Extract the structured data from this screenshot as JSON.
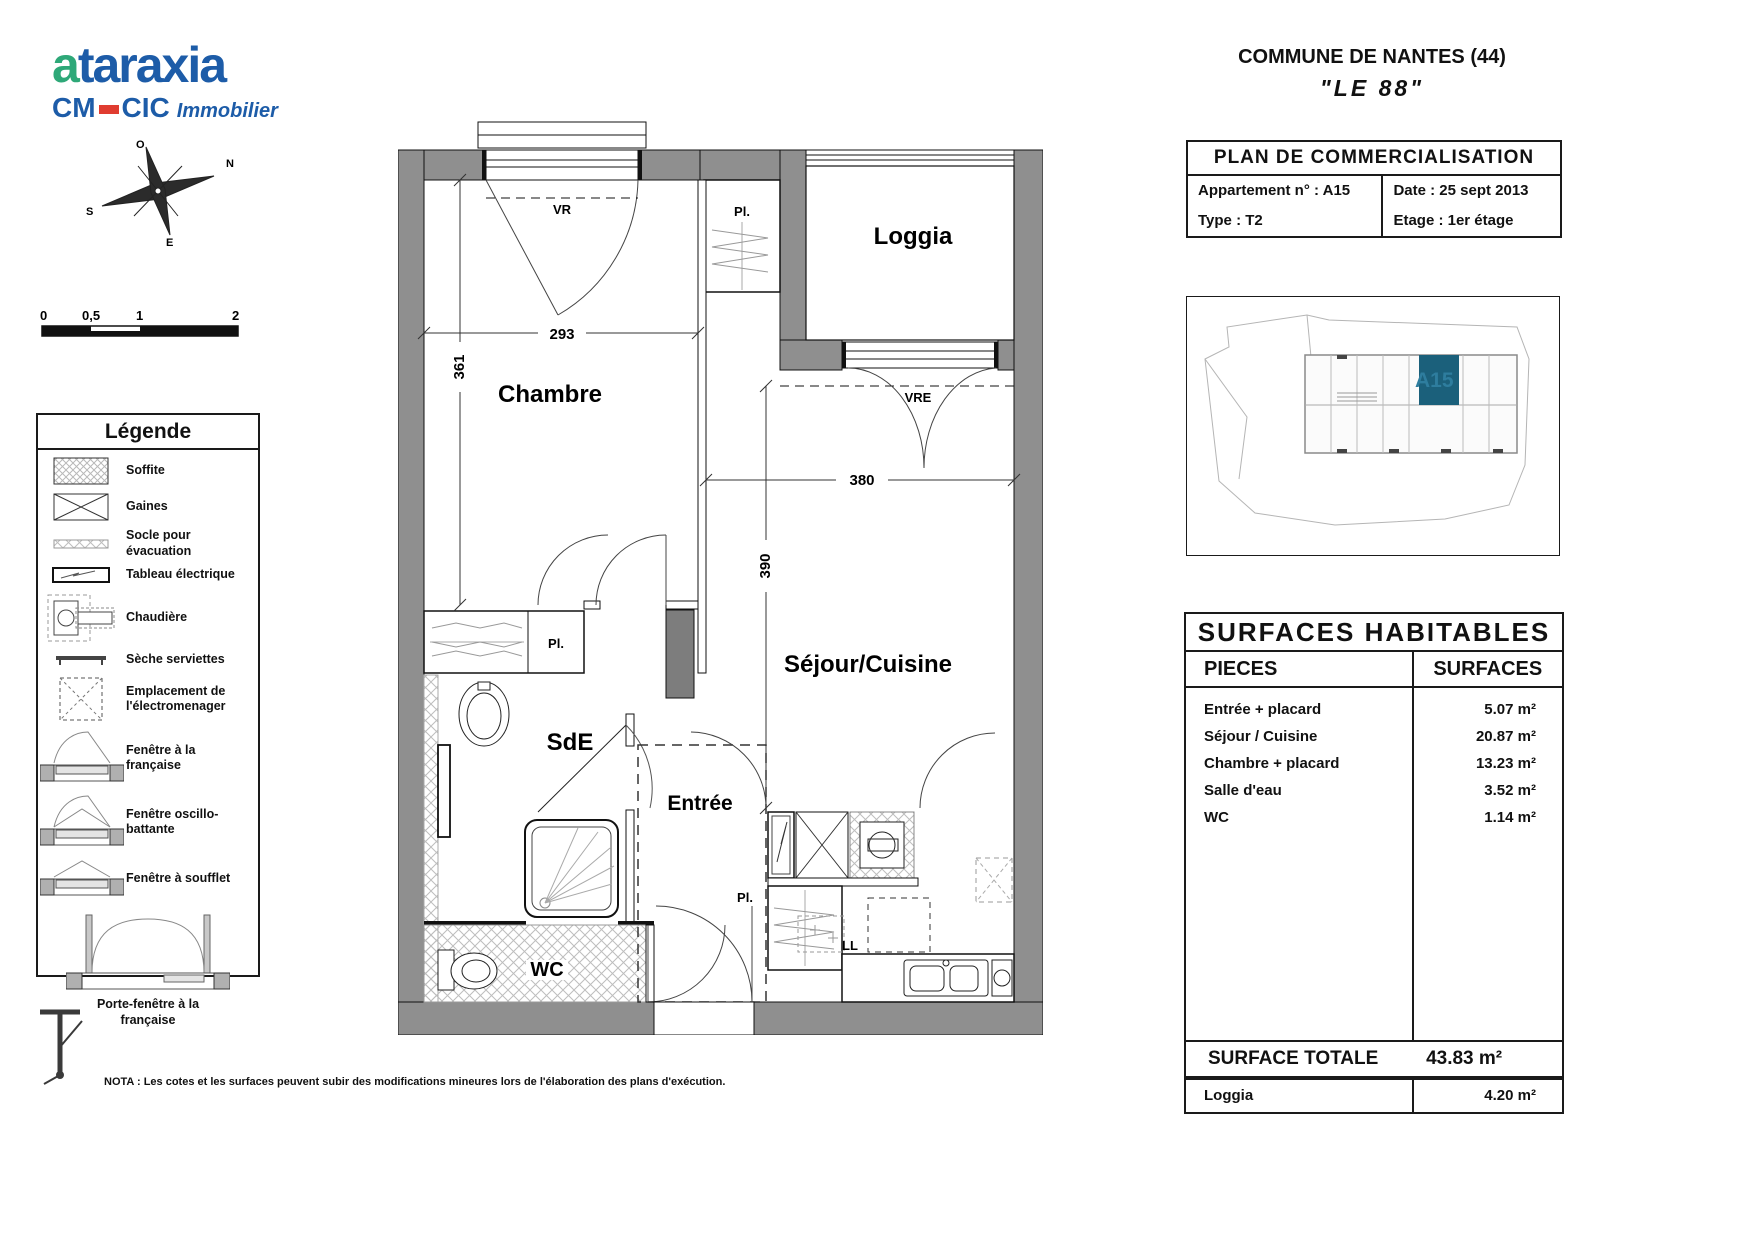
{
  "logo": {
    "brand_a": "a",
    "brand_rest": "taraxia",
    "cm": "CM",
    "cic": "CIC",
    "suffix": "Immobilier"
  },
  "header": {
    "commune": "COMMUNE DE NANTES (44)",
    "residence": "\"LE 88\""
  },
  "info_table": {
    "title": "PLAN DE COMMERCIALISATION",
    "appartement": "Appartement n° :  A15",
    "date": "Date : 25 sept 2013",
    "type": "Type : T2",
    "etage": "Etage : 1er étage"
  },
  "minimap": {
    "unit": "A15",
    "highlight_color": "#1b607b",
    "label_color": "#2e7d9e"
  },
  "surfaces": {
    "title": "SURFACES HABITABLES",
    "col_pieces": "PIECES",
    "col_surfaces": "SURFACES",
    "rows": [
      {
        "piece": "Entrée + placard",
        "surface": "5.07  m²"
      },
      {
        "piece": "Séjour / Cuisine",
        "surface": "20.87  m²"
      },
      {
        "piece": "Chambre + placard",
        "surface": "13.23  m²"
      },
      {
        "piece": "Salle d'eau",
        "surface": "3.52  m²"
      },
      {
        "piece": "WC",
        "surface": "1.14  m²"
      }
    ],
    "total_label": "SURFACE TOTALE",
    "total_value": "43.83 m²",
    "loggia_label": "Loggia",
    "loggia_value": "4.20  m²"
  },
  "legend": {
    "title": "Légende",
    "items": [
      "Soffite",
      "Gaines",
      "Socle pour évacuation",
      "Tableau électrique",
      "Chaudière",
      "Sèche serviettes",
      "Emplacement de l'électromenager",
      "Fenêtre à la française",
      "Fenêtre oscillo-battante",
      "Fenêtre à soufflet",
      "Porte-fenêtre à la française"
    ]
  },
  "scalebar": {
    "l0": "0",
    "l05": "0,5",
    "l1": "1",
    "l2": "2"
  },
  "compass": {
    "n": "N",
    "s": "S",
    "e": "E",
    "o": "O"
  },
  "plan": {
    "rooms": {
      "chambre": "Chambre",
      "loggia": "Loggia",
      "sde": "SdE",
      "entree": "Entrée",
      "wc": "WC",
      "sejour": "Séjour/Cuisine"
    },
    "dims": {
      "w_chambre": "293",
      "h_chambre": "361",
      "w_sejour": "380",
      "h_sejour": "390"
    },
    "tags": {
      "vr": "VR",
      "vre": "VRE",
      "pl": "Pl.",
      "ll": "LL"
    }
  },
  "nota": "NOTA : Les cotes et les surfaces peuvent subir des modifications mineures lors de l'élaboration des plans d'exécution."
}
